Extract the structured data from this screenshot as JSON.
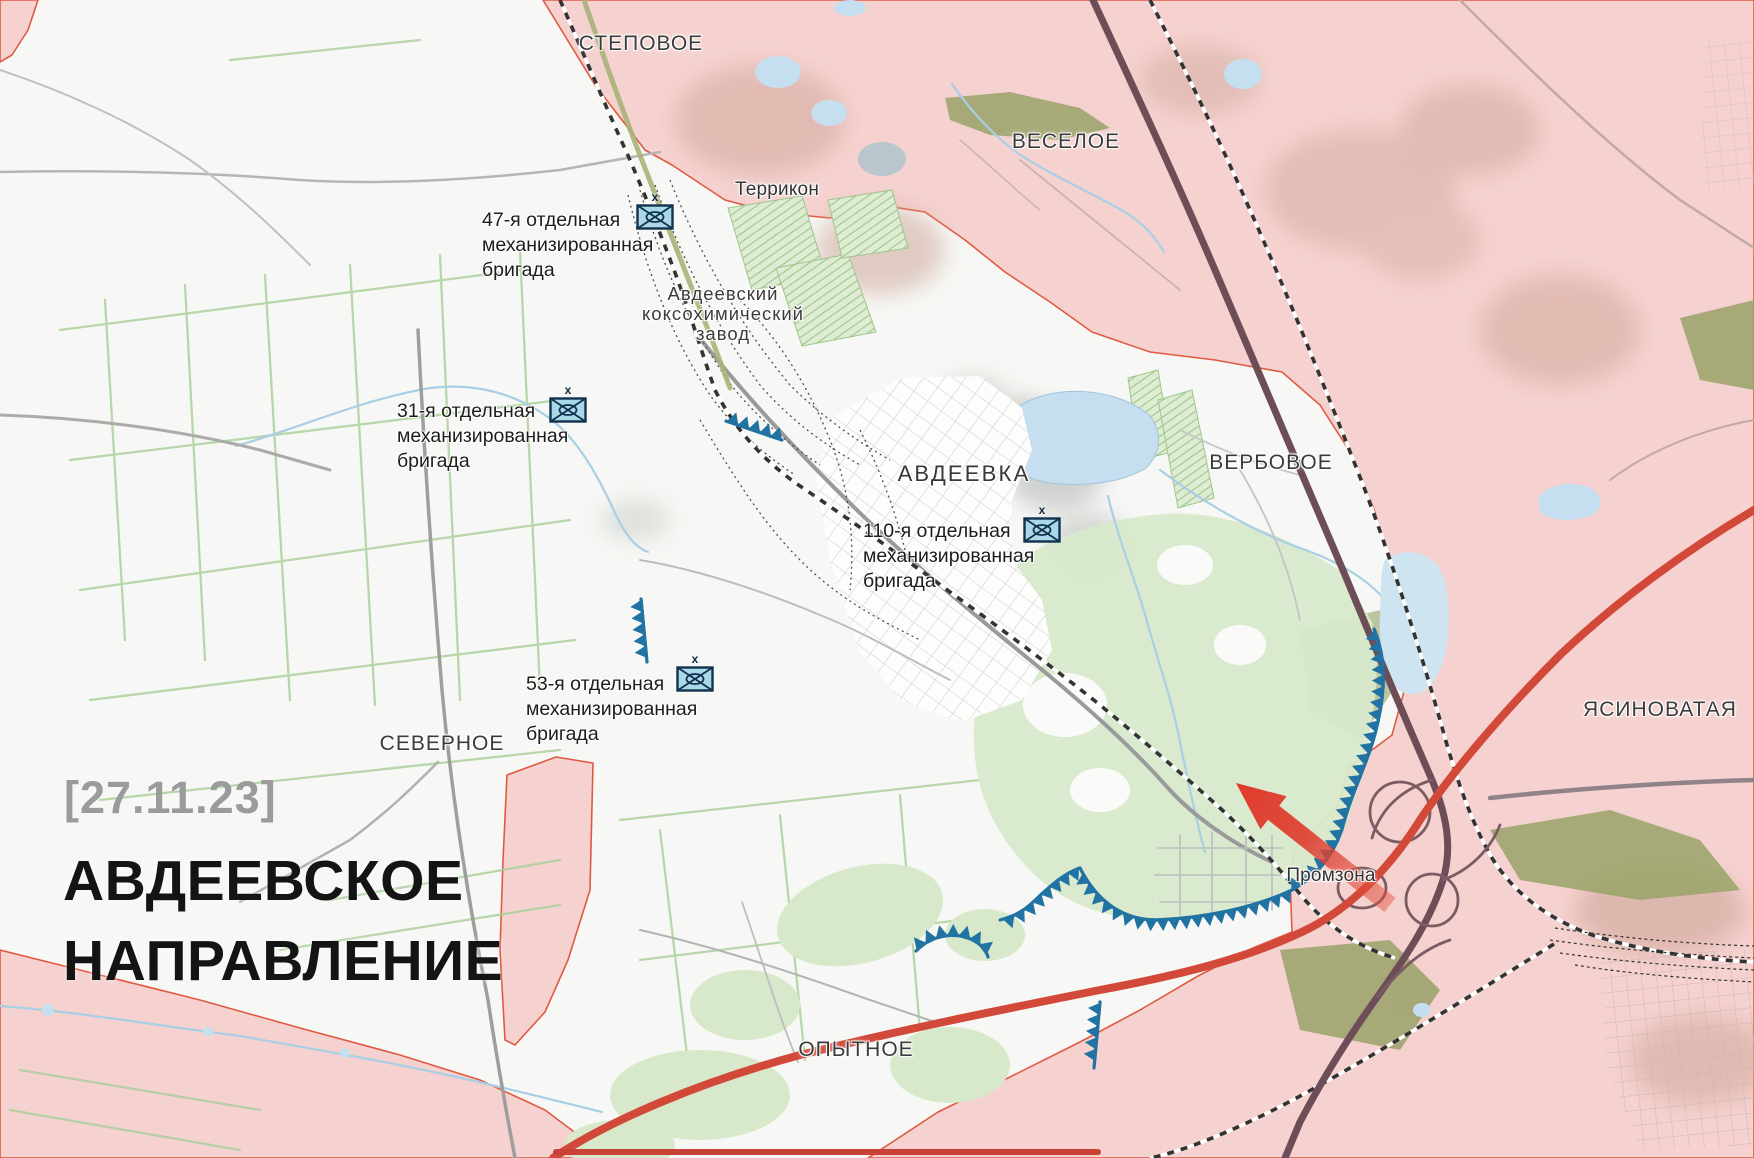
{
  "map_meta": {
    "date_label": "[27.11.23]",
    "title_line1": "АВДЕЕВСКОЕ",
    "title_line2": "НАПРАВЛЕНИЕ"
  },
  "settlements": {
    "stepove": "СТЕПОВОЕ",
    "vesele": "ВЕСЕЛОЕ",
    "avdiivka": "АВДЕЕВКА",
    "verbove": "ВЕРБОВОЕ",
    "yasynuvata": "ЯСИНОВАТАЯ",
    "severne": "СЕВЕРНОЕ",
    "opytne": "ОПЫТНОЕ"
  },
  "landmarks": {
    "terrikon": "Террикон",
    "koksozavod_line1": "Авдеевский",
    "koksozavod_line2": "коксохимический",
    "koksozavod_line3": "завод",
    "promzona": "Промзона"
  },
  "units": [
    {
      "echelon": "x",
      "line1": "47-я отдельная",
      "line2": "механизированная",
      "line3": "бригада"
    },
    {
      "echelon": "x",
      "line1": "31-я отдельная",
      "line2": "механизированная",
      "line3": "бригада"
    },
    {
      "echelon": "x",
      "line1": "110-я отдельная",
      "line2": "механизированная",
      "line3": "бригада"
    },
    {
      "echelon": "x",
      "line1": "53-я отдельная",
      "line2": "механизированная",
      "line3": "бригада"
    }
  ],
  "colors": {
    "occupied_fill": "#f5d2cf",
    "occupied_border": "#e05a41",
    "front_line_blue": "#2173a3",
    "unit_icon_fill": "#a9d9e9",
    "unit_icon_border": "#12314e",
    "arrow_red": "#df3b2c",
    "water": "#c6dff0",
    "green_field": "#d8e9cb",
    "title_black": "#141414",
    "date_gray": "#9b9b9b"
  }
}
